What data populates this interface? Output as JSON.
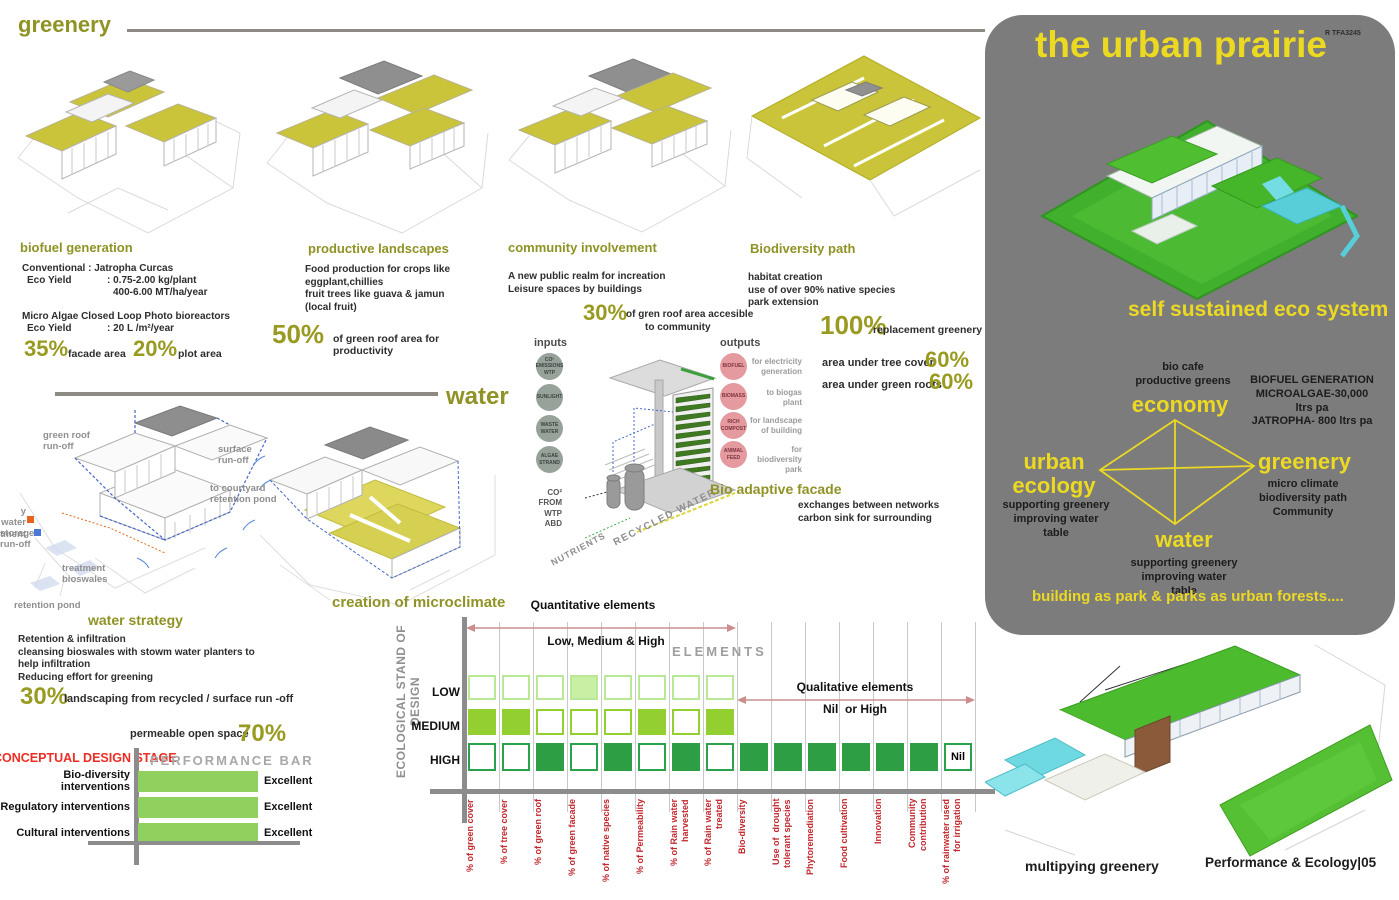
{
  "greenery_section": {
    "title": "greenery"
  },
  "biofuel": {
    "title": "biofuel generation",
    "conventional": "Conventional : Jatropha Curcas",
    "eco_yield_label1": "Eco Yield",
    "eco_yield_value1": ": 0.75-2.00 kg/plant",
    "eco_yield_value1b": "400-6.00 MT/ha/year",
    "micro_algae": "Micro Algae Closed Loop Photo bioreactors",
    "eco_yield_label2": "Eco Yield",
    "eco_yield_value2": ": 20 L /m²/year",
    "stat1_value": "35%",
    "stat1_label": "facade area",
    "stat2_value": "20%",
    "stat2_label": "plot area"
  },
  "productive": {
    "title": "productive landscapes",
    "body": "Food production for crops like\neggplant,chillies\nfruit trees like guava & jamun\n(local fruit)",
    "stat_value": "50%",
    "stat_label": "of green roof area for\nproductivity"
  },
  "community": {
    "title": "community involvement",
    "body": "A new public realm for increation\nLeisure spaces by buildings",
    "stat_value": "30%",
    "stat_label1": "of gren roof area accesible",
    "stat_label2": "to community"
  },
  "biodiversity": {
    "title": "Biodiversity path",
    "body": "habitat creation\nuse of over 90% native species\npark extension",
    "stat1_value": "100%",
    "stat1_label": "replacement greenery",
    "stat2_label": "area under tree cover",
    "stat2_value": "60%",
    "stat3_label": "area under green roofs",
    "stat3_value": "60%"
  },
  "water_section": {
    "title": "water",
    "microclimate": "creation of microclimate",
    "labels": {
      "green_roof_runoff": "green roof\nrun-off",
      "surface_runoff": "surface\nrun-off",
      "courtyard": "to courtyard\nretention pond",
      "grey_water": "y water\ntment",
      "storage": "storage",
      "runoff": "run-off",
      "bioswales": "treatment\nbioswales",
      "retention_pond": "retention pond"
    },
    "strategy_title": "water strategy",
    "strategy_body": "Retention & infiltration\ncleansing bioswales with stowm water planters to\nhelp infiltration\nReducing effort for greening",
    "stat1_value": "30%",
    "stat1_label": "landscaping from recycled / surface run -off",
    "stat2_label": "permeable open space",
    "stat2_value": "70%"
  },
  "facade_diagram": {
    "inputs_title": "inputs",
    "inputs": [
      "CO²\nEMISSIONS\nWTP",
      "SUNLIGHT",
      "WASTE\nWATER",
      "ALGAE\nSTRAND"
    ],
    "outputs_title": "outputs",
    "outputs": [
      {
        "name": "BIOFUEL",
        "desc": "for electricity\ngeneration"
      },
      {
        "name": "BIOMASS",
        "desc": "to biogas\nplant"
      },
      {
        "name": "RICH\nCOMPOST",
        "desc": "for landscape\nof building"
      },
      {
        "name": "ANIMAL\nFEED",
        "desc": "for biodiversity\npark"
      }
    ],
    "co2_label": "CO²\nFROM WTP\nABD",
    "nutrients_label": "NUTRIENTS",
    "recycled_label": "RECYCLED WATER",
    "title": "Bio adaptive facade",
    "subtitle": "exchanges between networks\ncarbon sink for surrounding"
  },
  "urban_prairie": {
    "title": "the urban prairie",
    "code": "R TFA3245",
    "subtitle": "self sustained eco system",
    "economy_note": "bio cafe\nproductive greens",
    "biofuel_note": "BIOFUEL GENERATION\nMICROALGAE-30,000 ltrs pa\nJATROPHA- 800 ltrs pa",
    "node_economy": "economy",
    "node_urban_ecology": "urban\necology",
    "urban_ecology_note": "supporting greenery\nimproving water table",
    "node_greenery": "greenery",
    "greenery_note": "micro climate\nbiodiversity path\nCommunity",
    "node_water": "water",
    "water_note": "supporting greenery\nimproving water table",
    "tagline": "building as park & parks as urban forests...."
  },
  "footer": {
    "caption": "multipying greenery",
    "sheet_title": "Performance & Ecology|05"
  },
  "chart_data": [
    {
      "type": "heatmap",
      "title": "ECOLOGICAL STAND OF DESIGN",
      "group1_label": "Quantitative elements",
      "group1_sub": "Low, Medium & High",
      "group2_label": "Qualitative elements",
      "group2_sub": "Nil  or High",
      "elements_label": "ELEMENTS",
      "rows": [
        "LOW",
        "MEDIUM",
        "HIGH"
      ],
      "columns": [
        "% of green cover",
        "% of tree cover",
        "% of green roof",
        "% of green facade",
        "% of native species",
        "% of Permeability",
        "% of Rain water\nharvested",
        "% of Rain water\ntreated",
        "Bio-diversity",
        "Use of  drought\ntolerant species",
        "Phytoremediation",
        "Food cultivation",
        "Innovation",
        "Community\ncontribution",
        "% of rainwater used\nfor irrigation"
      ],
      "low_states": [
        "outline",
        "outline",
        "outline",
        "filled",
        "outline",
        "outline",
        "outline",
        "outline"
      ],
      "medium_states": [
        "filled",
        "filled",
        "outline",
        "outline",
        "outline",
        "filled",
        "outline",
        "filled"
      ],
      "high_states": [
        "outline",
        "outline",
        "filled",
        "outline",
        "filled",
        "outline",
        "filled",
        "outline",
        "filled",
        "filled",
        "filled",
        "filled",
        "filled",
        "filled",
        "nil"
      ],
      "nil_label": "Nil"
    },
    {
      "type": "bar",
      "title": "PERFORMANCE BAR",
      "stage_label": "CONCEPTUAL DESIGN STAGE",
      "categories": [
        "Bio-diversity interventions",
        "Regulatory interventions",
        "Cultural interventions"
      ],
      "values": [
        "Excellent",
        "Excellent",
        "Excellent"
      ]
    }
  ],
  "colors": {
    "olive": "#8f9224",
    "yellow": "#ecd922",
    "panel_gray": "#7c7c7c",
    "red_label": "#c1272d",
    "bar_green": "#8fd05f",
    "low_green": "#c9efa4",
    "medium_green": "#94cf32",
    "high_green": "#2e9e44"
  }
}
